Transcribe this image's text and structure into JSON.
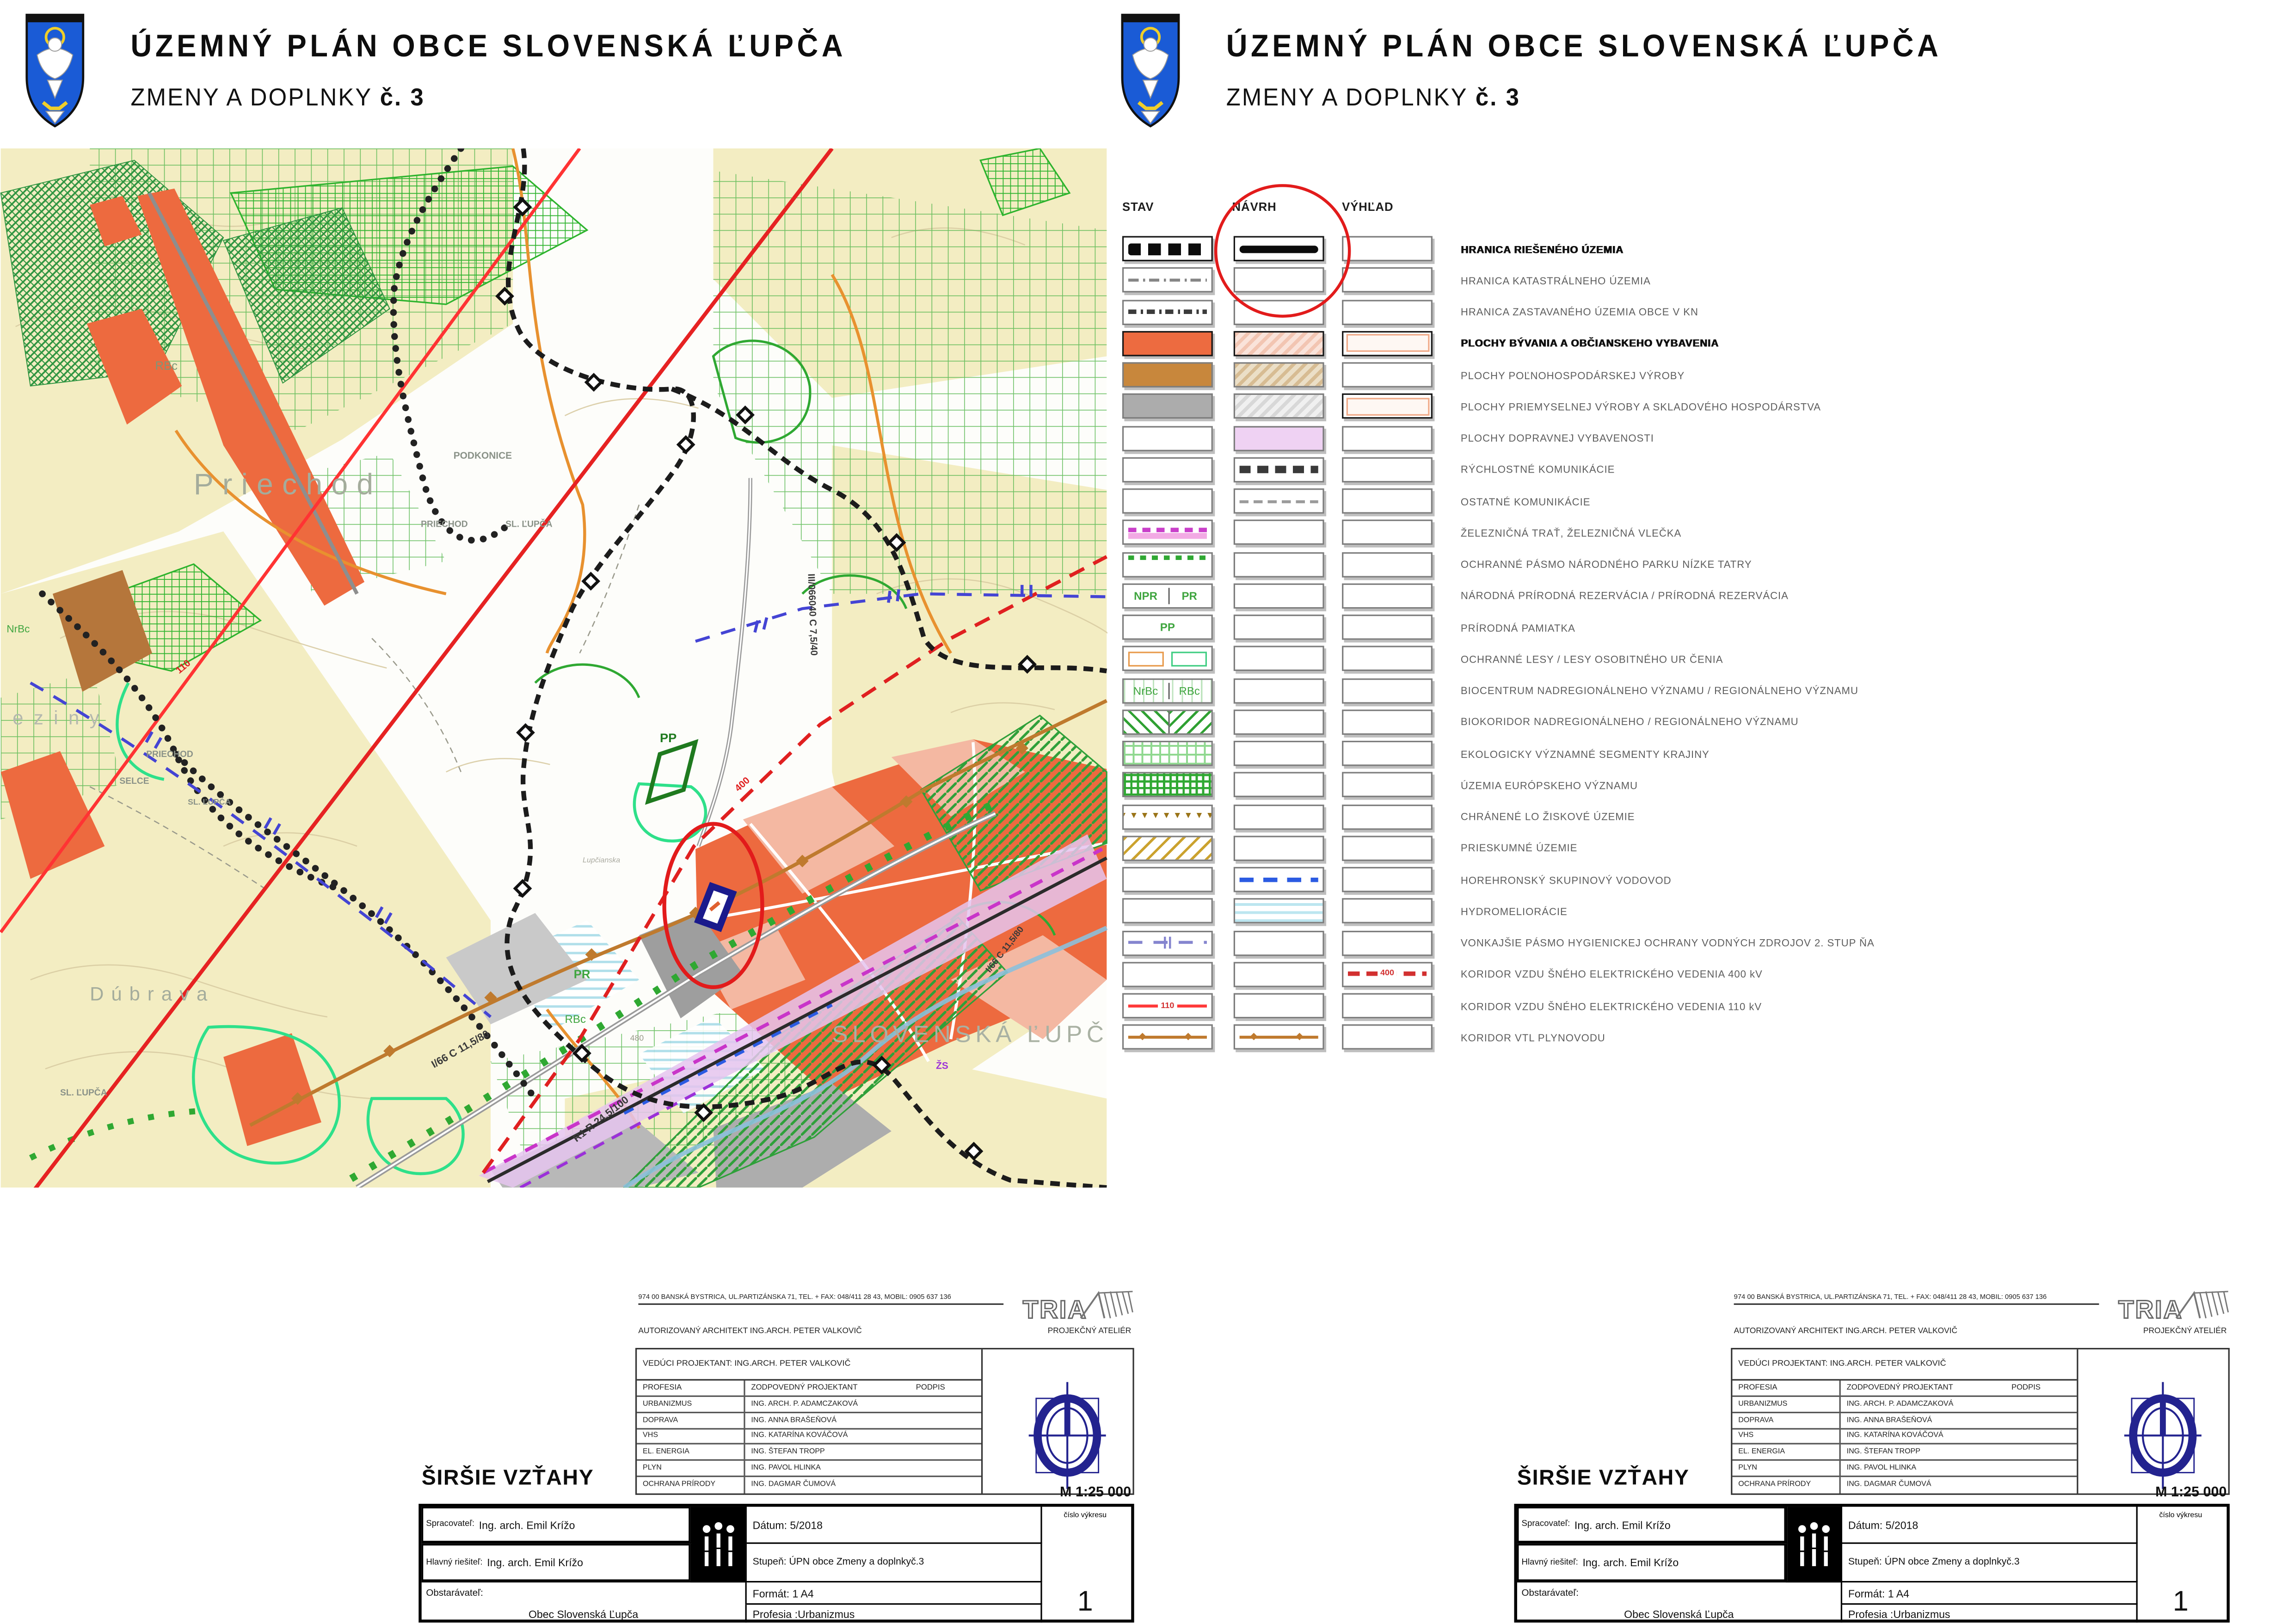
{
  "page_bg": "#ffffff",
  "annotation_color": "#e21b1b",
  "header": {
    "title_line1": "ÚZEMNÝ  PLÁN  OBCE  SLOVENSKÁ  ĽUPČA",
    "title_line2_prefix": "ZMENY A DOPLNKY ",
    "title_line2_number": "č. 3",
    "crest": "slovenska-lupca-coat-of-arms"
  },
  "legend": {
    "columns": [
      "STAV",
      "NÁVRH",
      "VÝHĽAD"
    ],
    "rows": [
      {
        "label": "HRANICA RIEŠENÉHO ÚZEMIA",
        "bold": true,
        "stav": "dash-black-thick",
        "navrh": "line-black-thick",
        "vyhlad": "none"
      },
      {
        "label": "HRANICA KATASTRÁLNEHO ÚZEMIA",
        "stav": "dash-gray",
        "navrh": "none",
        "vyhlad": "none"
      },
      {
        "label": "HRANICA ZASTAVANÉHO ÚZEMIA OBCE V KN",
        "stav": "dash-dark",
        "navrh": "none",
        "vyhlad": "none"
      },
      {
        "label": "PLOCHY  BÝVANIA  A  OBČIANSKEHO  VYBAVENIA",
        "bold": true,
        "stav": "fill-orange",
        "navrh": "hatch-pink",
        "vyhlad": "outline-pink"
      },
      {
        "label": "PLOCHY  POĽNOHOSPODÁRSKEJ  VÝROBY",
        "stav": "fill-brown",
        "navrh": "hatch-tan",
        "vyhlad": "none"
      },
      {
        "label": "PLOCHY  PRIEMYSELNEJ  VÝROBY  A  SKLADOVÉHO  HOSPODÁRSTVA",
        "stav": "fill-gray",
        "navrh": "hatch-lightgray",
        "vyhlad": "outline-pink"
      },
      {
        "label": "PLOCHY  DOPRAVNEJ  VYBAVENOSTI",
        "stav": "none",
        "navrh": "fill-lavender",
        "vyhlad": "none"
      },
      {
        "label": "RÝCHLOSTNÉ  KOMUNIKÁCIE",
        "stav": "none",
        "navrh": "dash-dark-thick",
        "vyhlad": "none"
      },
      {
        "label": "OSTATNÉ  KOMUNIKÁCIE",
        "stav": "none",
        "navrh": "dash-gray-thin",
        "vyhlad": "none"
      },
      {
        "label": "ŽELEZNIČNÁ  TRAŤ, ŽELEZNIČNÁ  VLEČKA",
        "stav": "railway",
        "navrh": "none",
        "vyhlad": "none"
      },
      {
        "label": "OCHRANNÉ PÁSMO NÁRODNÉHO PARKU NÍZKE TATRY",
        "stav": "green-dotted",
        "navrh": "none",
        "vyhlad": "none"
      },
      {
        "label": "NÁRODNÁ  PRÍRODNÁ  REZERVÁCIA / PRÍRODNÁ  REZERVÁCIA",
        "stav": "split-text",
        "stav_texts": [
          "NPR",
          "PR"
        ],
        "navrh": "none",
        "vyhlad": "none"
      },
      {
        "label": "PRÍRODNÁ  PAMIATKA",
        "stav": "center-text",
        "stav_texts": [
          "PP"
        ],
        "navrh": "none",
        "vyhlad": "none"
      },
      {
        "label": "OCHRANNÉ  LESY / LESY OSOBITNÉHO UR ČENIA",
        "stav": "forest-duo",
        "navrh": "none",
        "vyhlad": "none"
      },
      {
        "label": "BIOCENTRUM  NADREGIONÁLNEHO  VÝZNAMU /  REGIONÁLNEHO  VÝZNAMU",
        "stav": "split-text-lines",
        "stav_texts": [
          "NrBc",
          "RBc"
        ],
        "navrh": "none",
        "vyhlad": "none"
      },
      {
        "label": "BIOKORIDOR  NADREGIONÁLNEHO / REGIONÁLNEHO  VÝZNAMU",
        "stav": "green-diag-duo",
        "navrh": "none",
        "vyhlad": "none"
      },
      {
        "label": "EKOLOGICKY VÝZNAMNÉ SEGMENTY KRAJINY",
        "stav": "green-grid",
        "navrh": "none",
        "vyhlad": "none"
      },
      {
        "label": "ÚZEMIA EURÓPSKEHO VÝZNAMU",
        "stav": "green-grid-dense",
        "navrh": "none",
        "vyhlad": "none"
      },
      {
        "label": "CHRÁNENÉ  LO ŽISKOVÉ  ÚZEMIE",
        "stav": "triangles-brown",
        "stav_texts": [
          "▼▼▼▼▼▼▼▼▼"
        ],
        "navrh": "none",
        "vyhlad": "none"
      },
      {
        "label": "PRIESKUMNÉ  ÚZEMIE",
        "stav": "hatch-gold",
        "navrh": "none",
        "vyhlad": "none"
      },
      {
        "label": "HOREHRONSKÝ  SKUPINOVÝ  VODOVOD",
        "stav": "none",
        "navrh": "dash-blue",
        "vyhlad": "none"
      },
      {
        "label": "HYDROMELIORÁCIE",
        "stav": "none",
        "navrh": "lines-cyan",
        "vyhlad": "none"
      },
      {
        "label": "VONKAJŠIE  PÁSMO  HYGIENICKEJ  OCHRANY  VODNÝCH  ZDROJOV  2. STUP ŇA",
        "stav": "dash-violet-ticks",
        "navrh": "none",
        "vyhlad": "none"
      },
      {
        "label": "KORIDOR  VZDU ŠNÉHO  ELEKTRICKÉHO  VEDENIA   400 kV",
        "stav": "none",
        "navrh": "none",
        "vyhlad": "line-red-dash-label",
        "vyhlad_label": "400"
      },
      {
        "label": "KORIDOR  VZDU ŠNÉHO  ELEKTRICKÉHO  VEDENIA   110 kV",
        "stav": "line-red-label",
        "stav_label": "110",
        "navrh": "none",
        "vyhlad": "none"
      },
      {
        "label": "KORIDOR  VTL  PLYNOVODU",
        "stav": "gas",
        "stav_texts": [
          "◆ ◆"
        ],
        "navrh": "gas",
        "navrh_texts": [
          "◆ ◆"
        ],
        "vyhlad": "none"
      }
    ]
  },
  "map": {
    "labels": [
      {
        "text": "Priechod"
      },
      {
        "text": "Dúbrava"
      },
      {
        "text": "SLOVENSKÁ ĽUPČA"
      },
      {
        "text": "PODKONICE"
      },
      {
        "text": "PRIECHOD"
      },
      {
        "text": "SL. ĽUPČA"
      },
      {
        "text": "PRIECHOD"
      },
      {
        "text": "SELCE"
      },
      {
        "text": "SL. ĽUPČA"
      },
      {
        "text": "SL. ĽUPČA"
      },
      {
        "text": "eziny"
      },
      {
        "text": "RBc"
      },
      {
        "text": "RBc"
      },
      {
        "text": "PR"
      },
      {
        "text": "PP"
      },
      {
        "text": "NrBc"
      },
      {
        "text": "ŽS"
      },
      {
        "text": "480"
      },
      {
        "text": "400"
      },
      {
        "text": "110"
      },
      {
        "text": "I/66 C 11,5/80"
      },
      {
        "text": "R1 R 24,5/100"
      },
      {
        "text": "III/066040 C 7,5/40"
      },
      {
        "text": "I/66 C 11,5/80"
      },
      {
        "text": "Lupčianska"
      }
    ]
  },
  "titleblock": {
    "address": "974 00 BANSKÁ BYSTRICA, UL.PARTIZÁNSKA 71, TEL. + FAX: 048/411 28 43, MOBIL: 0905 637 136",
    "logo_text": "TRIA",
    "architect": "AUTORIZOVANÝ ARCHITEKT ING.ARCH. PETER VALKOVIČ",
    "atelier": "PROJEKČNÝ ATELIÉR",
    "veduci": "VEDÚCI PROJEKTANT: ING.ARCH. PETER VALKOVIČ",
    "prof_header": [
      "PROFESIA",
      "ZODPOVEDNÝ PROJEKTANT",
      "PODPIS"
    ],
    "professions": [
      {
        "profession": "URBANIZMUS",
        "designer": "ING. ARCH. P. ADAMCZAKOVÁ"
      },
      {
        "profession": "DOPRAVA",
        "designer": "ING. ANNA  BRAŠEŇOVÁ"
      },
      {
        "profession": "VHS",
        "designer": "ING. KATARÍNA  KOVÁČOVÁ"
      },
      {
        "profession": "EL. ENERGIA",
        "designer": "ING. ŠTEFAN  TROPP"
      },
      {
        "profession": "PLYN",
        "designer": "ING. PAVOL  HLINKA"
      },
      {
        "profession": "OCHRANA  PRÍRODY",
        "designer": "ING. DAGMAR  ČUMOVÁ"
      }
    ],
    "scale": "M 1:25 000",
    "drawing_title": "ŠIRŠIE VZŤAHY",
    "info": {
      "spracovatel_label": "Spracovateľ:",
      "spracovatel": "Ing. arch. Emil Krížo",
      "hlavny_label": "Hlavný riešiteľ:",
      "hlavny": "Ing. arch. Emil Krížo",
      "obstaravatel_label": "Obstarávateľ:",
      "obstaravatel": "Obec Slovenská Ľupča",
      "datum_label": "Dátum:",
      "datum": "5/2018",
      "stupen_label": "Stupeň:",
      "stupen": "ÚPN obce Zmeny a doplnkyč.3",
      "format_label": "Formát:",
      "format": "1 A4",
      "profesia_label": "Profesia :",
      "profesia": "Urbanizmus",
      "cislo_label": "číslo výkresu",
      "cislo": "1"
    }
  }
}
